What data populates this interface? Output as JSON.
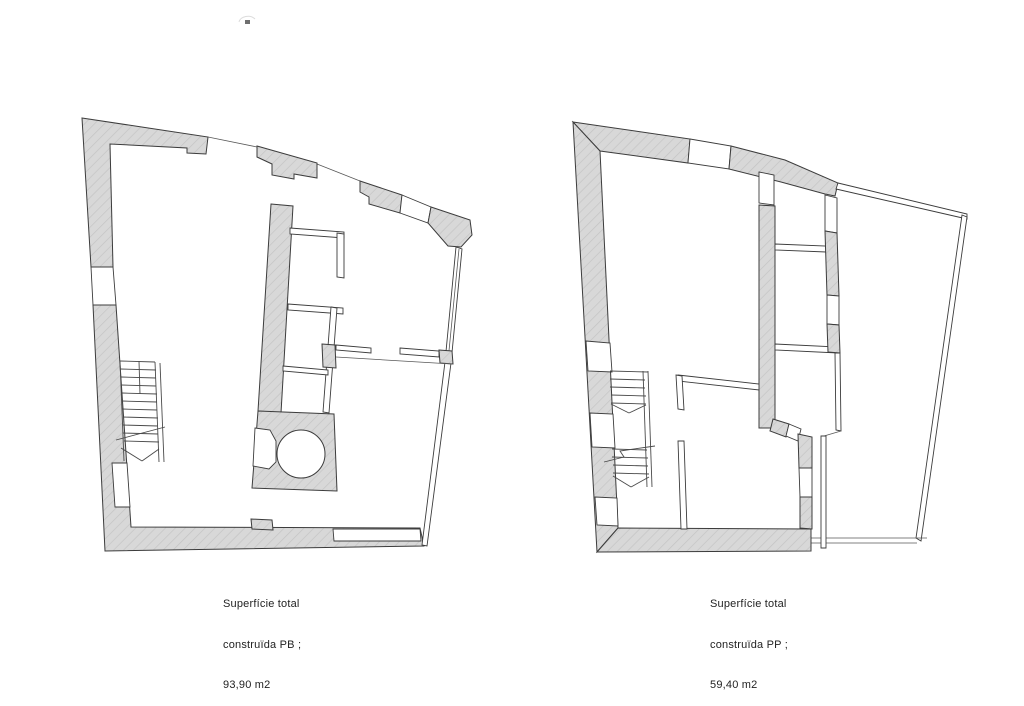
{
  "colors": {
    "background": "#ffffff",
    "wall_fill": "#d8d8d8",
    "hatch_line": "#c3c3c3",
    "outline": "#3c3c3c",
    "thin_line": "#585858",
    "text": "#222222"
  },
  "plans": [
    {
      "name": "planta-baixa",
      "caption": {
        "line1": "Superfície total",
        "line2": "construïda PB ;",
        "line3": "93,90 m2"
      }
    },
    {
      "name": "planta-pis",
      "caption": {
        "line1": "Superfície total",
        "line2": "construïda PP ;",
        "line3": "59,40 m2"
      }
    }
  ]
}
